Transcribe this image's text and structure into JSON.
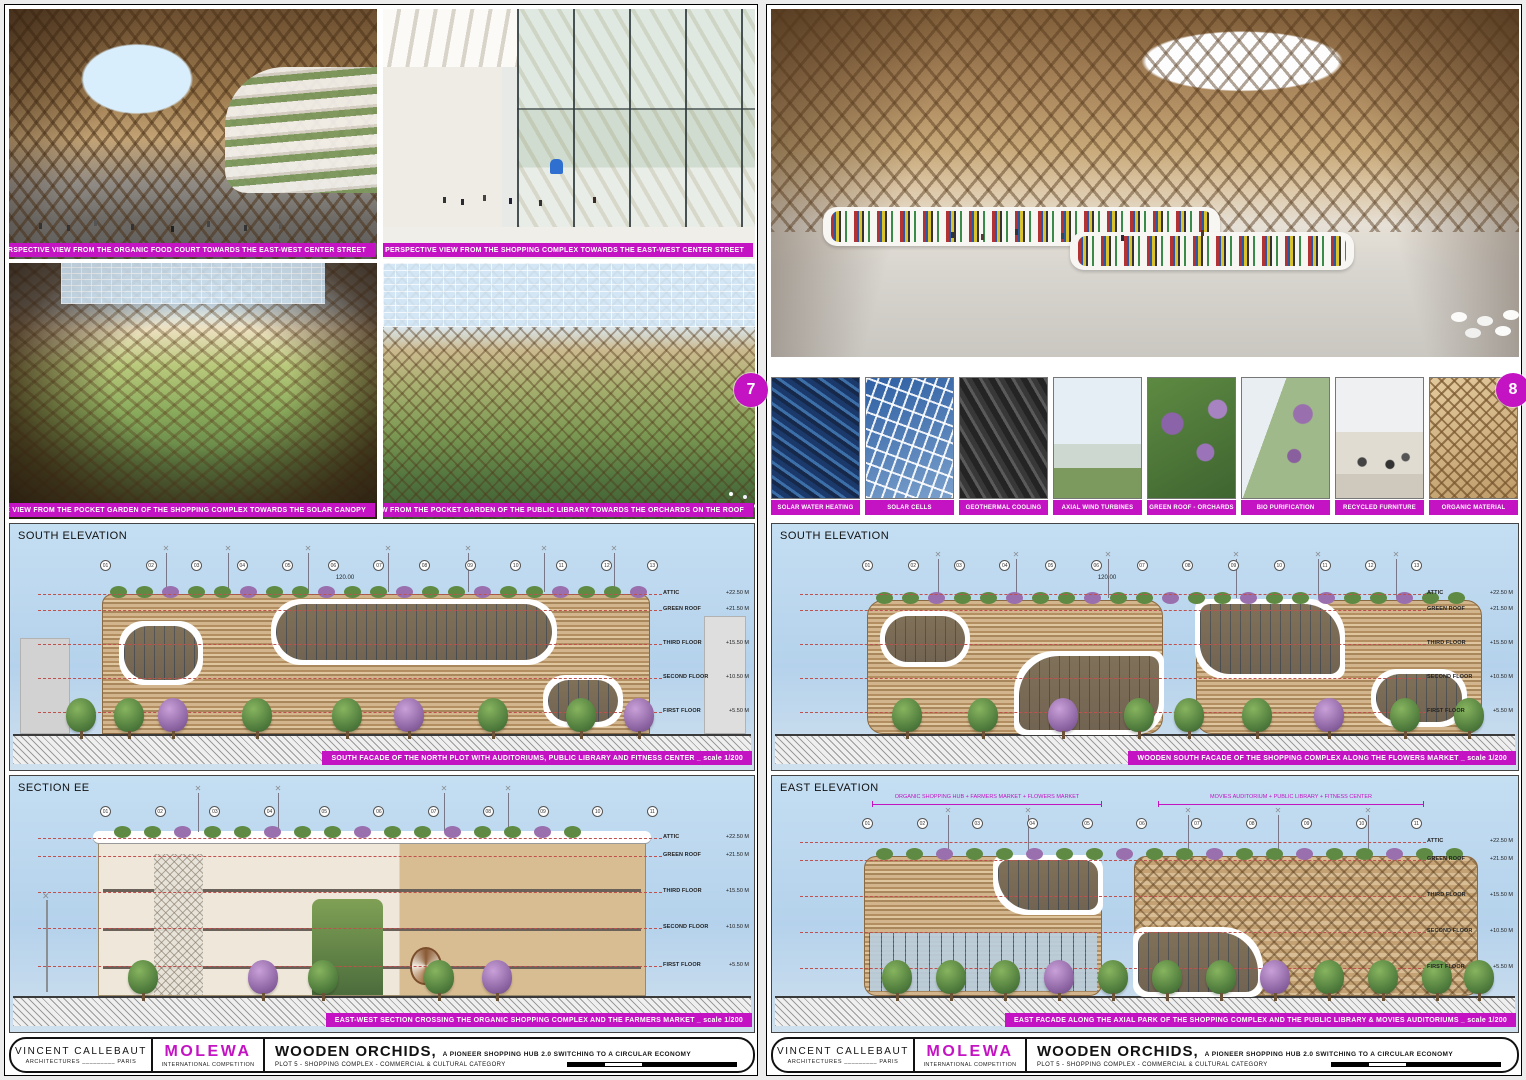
{
  "colors": {
    "magenta": "#c313c3",
    "sky": "#bdd9f1",
    "redline": "#c0504d",
    "wood": "#c8a87a"
  },
  "badges": {
    "left": "7",
    "right": "8"
  },
  "titleblock": {
    "architect_line1": "VINCENT CALLEBAUT",
    "architect_line2": "ARCHITECTURES _________ PARIS",
    "competition_line1": "MOLEWA",
    "competition_line2": "INTERNATIONAL COMPETITION",
    "project_title": "WOODEN ORCHIDS,",
    "project_subtitle": "A PIONEER SHOPPING HUB 2.0 SWITCHING TO A CIRCULAR ECONOMY",
    "project_category": "PLOT 5 - SHOPPING COMPLEX - COMMERCIAL & CULTURAL CATEGORY"
  },
  "left_sheet": {
    "perspectives": [
      {
        "caption": "PERSPECTIVE VIEW FROM THE ORGANIC FOOD COURT TOWARDS THE EAST-WEST CENTER STREET"
      },
      {
        "caption": "PERSPECTIVE VIEW FROM THE SHOPPING COMPLEX TOWARDS THE EAST-WEST CENTER STREET"
      },
      {
        "caption": "PERSPECTIVE VIEW FROM THE POCKET GARDEN OF THE SHOPPING COMPLEX TOWARDS THE SOLAR CANOPY"
      },
      {
        "caption": "PERSPECTIVE VIEW FROM THE POCKET GARDEN OF THE PUBLIC LIBRARY TOWARDS THE ORCHARDS ON THE ROOF"
      }
    ],
    "panels": [
      {
        "label": "SOUTH ELEVATION",
        "caption": "SOUTH FACADE OF THE NORTH PLOT WITH AUDITORIUMS, PUBLIC LIBRARY AND FITNESS CENTER _ scale 1/200",
        "dim": "120.00",
        "grid_bubbles": [
          "01",
          "02",
          "03",
          "04",
          "05",
          "06",
          "07",
          "08",
          "09",
          "10",
          "11",
          "12",
          "13"
        ]
      },
      {
        "label": "SECTION EE",
        "caption": "EAST-WEST SECTION CROSSING THE ORGANIC SHOPPING COMPLEX AND THE FARMERS MARKET _ scale 1/200",
        "grid_bubbles": [
          "01",
          "02",
          "03",
          "04",
          "05",
          "06",
          "07",
          "08",
          "09",
          "10",
          "11"
        ]
      }
    ]
  },
  "right_sheet": {
    "perspective_caption": "PERSPECTIVE VIEW OF THE PUBLIC LIBRARY IN OPEN SPACE INSIDE THE WOODEN ORCHIDS STRUCTURE",
    "thumbnails": [
      {
        "label": "SOLAR WATER HEATING"
      },
      {
        "label": "SOLAR CELLS"
      },
      {
        "label": "GEOTHERMAL COOLING"
      },
      {
        "label": "AXIAL WIND TURBINES"
      },
      {
        "label": "GREEN ROOF - ORCHARDS"
      },
      {
        "label": "BIO PURIFICATION"
      },
      {
        "label": "RECYCLED FURNITURE"
      },
      {
        "label": "ORGANIC MATERIAL"
      }
    ],
    "panels": [
      {
        "label": "SOUTH ELEVATION",
        "caption": "WOODEN SOUTH FACADE OF THE SHOPPING COMPLEX ALONG THE FLOWERS MARKET _ scale 1/200",
        "dim": "120.00",
        "grid_bubbles": [
          "01",
          "02",
          "03",
          "04",
          "05",
          "06",
          "07",
          "08",
          "09",
          "10",
          "11",
          "12",
          "13"
        ]
      },
      {
        "label": "EAST ELEVATION",
        "caption": "EAST FACADE ALONG THE AXIAL PARK OF THE SHOPPING COMPLEX AND THE PUBLIC LIBRARY & MOVIES AUDITORIUMS _ scale 1/200",
        "grid_bubbles": [
          "01",
          "02",
          "03",
          "04",
          "05",
          "06",
          "07",
          "08",
          "09",
          "10",
          "11"
        ],
        "headers": [
          "ORGANIC SHOPPING HUB + FARMERS MARKET + FLOWERS MARKET",
          "MOVIES AUDITORIUM + PUBLIC LIBRARY + FITNESS CENTER"
        ]
      }
    ]
  },
  "levels": [
    {
      "label": "ATTIC",
      "elev": "+22.50 M"
    },
    {
      "label": "GREEN ROOF",
      "elev": "+21.50 M"
    },
    {
      "label": "THIRD FLOOR",
      "elev": "+15.50 M"
    },
    {
      "label": "SECOND FLOOR",
      "elev": "+10.50 M"
    },
    {
      "label": "FIRST FLOOR",
      "elev": "+5.50 M"
    }
  ]
}
